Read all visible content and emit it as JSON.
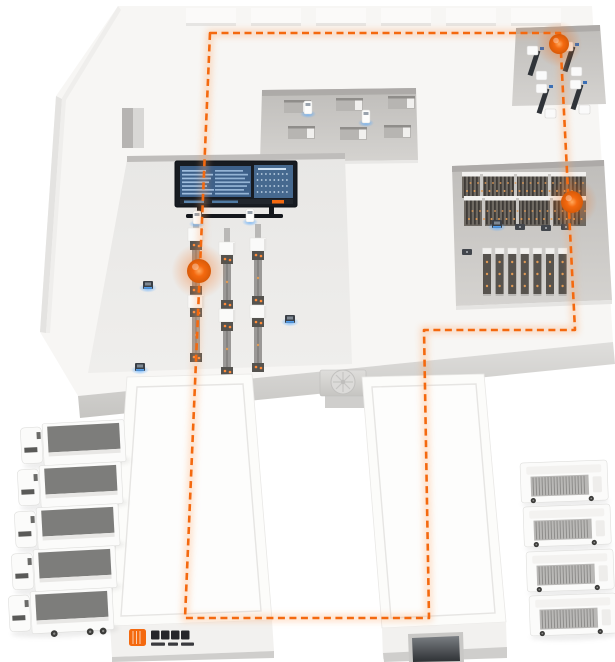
{
  "scene": {
    "kind": "isometric-smart-factory-logistics-illustration",
    "width": 615,
    "height": 662
  },
  "colors": {
    "accent": "#f4690f",
    "accent_glow": "#ffa25e",
    "blue_glow": "#58aaff",
    "dark": "#14171c",
    "screen_left": "#3d6089",
    "screen_right": "#46698f",
    "screen_text": "#aac9e9",
    "slab": "#f7f6f4",
    "hall": "#ecebe9",
    "bay_dark": "#c3c1be",
    "bay_light": "#d5d3d0",
    "wall_top": "#dfdedc",
    "wall_bottom": "#c6c5c2",
    "rail": "#9a9896",
    "rail_foot": "#55534f",
    "rack_body": "#6e6962",
    "rack_slat": "#3f3b37",
    "rack_cap": "#f2f1ef",
    "rack_dot": "#e09a55",
    "conveyor_box": "#fafaf9",
    "truck_body": "#fbfbfa",
    "truck_top": "#7d7d7b",
    "building_top": "#fcfcfa",
    "building_face": "#f2f1ef",
    "building_base": "#cfcecc",
    "door_dark": "#2e3134"
  },
  "route": {
    "points": [
      [
        210,
        33
      ],
      [
        560,
        33
      ],
      [
        575,
        330
      ],
      [
        424,
        330
      ],
      [
        429,
        618
      ],
      [
        185,
        618
      ]
    ],
    "closed": true,
    "dash": "7 4.5",
    "stroke_width": 2.6
  },
  "markers": [
    {
      "name": "station-inbound-machines",
      "x": 559,
      "y": 44,
      "r": 10
    },
    {
      "name": "station-storage-rack",
      "x": 572,
      "y": 202,
      "r": 11
    },
    {
      "name": "station-conveyor-line",
      "x": 199,
      "y": 271,
      "r": 12
    }
  ],
  "skylights": {
    "y": 8,
    "h": 18,
    "w": 50,
    "xs": [
      186,
      251,
      316,
      381,
      446,
      511
    ]
  },
  "conveyors": {
    "columns": [
      {
        "x": 196,
        "top": 214
      },
      {
        "x": 227,
        "top": 228
      },
      {
        "x": 258,
        "top": 224
      }
    ],
    "segments": [
      [
        "stub",
        14
      ],
      [
        "box",
        13
      ],
      [
        "foot",
        9
      ],
      [
        "rail",
        36
      ],
      [
        "foot",
        9
      ],
      [
        "box",
        13
      ],
      [
        "foot",
        9
      ],
      [
        "rail",
        36
      ],
      [
        "foot",
        9
      ]
    ]
  },
  "rack_area": {
    "bands": [
      {
        "x": 462,
        "y": 172,
        "w": 124,
        "h": 26
      },
      {
        "x": 464,
        "y": 196,
        "w": 122,
        "h": 30
      }
    ],
    "lower": {
      "x": 487,
      "y": 248,
      "count": 7,
      "pitch": 12.6,
      "cap_h": 6,
      "body_h": 40
    },
    "shuttles": [
      [
        520,
        227
      ],
      [
        546,
        228
      ],
      [
        566,
        227
      ],
      [
        467,
        252
      ]
    ]
  },
  "machines": [
    [
      534,
      50
    ],
    [
      569,
      46
    ],
    [
      543,
      88
    ],
    [
      577,
      84
    ]
  ],
  "desks": [
    [
      284,
      100
    ],
    [
      336,
      98
    ],
    [
      388,
      96
    ],
    [
      288,
      126
    ],
    [
      340,
      127
    ],
    [
      384,
      125
    ]
  ],
  "agvs": [
    [
      308,
      107
    ],
    [
      366,
      116
    ],
    [
      250,
      215
    ],
    [
      197,
      217
    ]
  ],
  "devices": [
    [
      148,
      285
    ],
    [
      290,
      319
    ],
    [
      140,
      367
    ],
    [
      497,
      224
    ]
  ],
  "trucks_left": {
    "count": 5,
    "angle": -3,
    "positions": [
      [
        20,
        424
      ],
      [
        17,
        466
      ],
      [
        14,
        508
      ],
      [
        11,
        550
      ],
      [
        8,
        592
      ]
    ]
  },
  "trucks_right": {
    "count": 4,
    "angle": -2,
    "positions": [
      [
        520,
        463
      ],
      [
        523,
        507
      ],
      [
        526,
        552
      ],
      [
        529,
        596
      ]
    ]
  },
  "hvac": {
    "x": 320,
    "y": 370,
    "w": 46,
    "h": 26,
    "fan_cx": 343,
    "fan_cy": 382,
    "fan_r": 12
  },
  "dashboard": {
    "x": 175,
    "y": 161,
    "w": 122,
    "h": 46,
    "left_rows": 7,
    "right_dot_rows": 4,
    "right_dot_cols": 8
  },
  "brand": {
    "logo_color": "#f4690f",
    "text_color": "#26262a",
    "char_blocks": 4,
    "subtitle_blocks": 3
  }
}
